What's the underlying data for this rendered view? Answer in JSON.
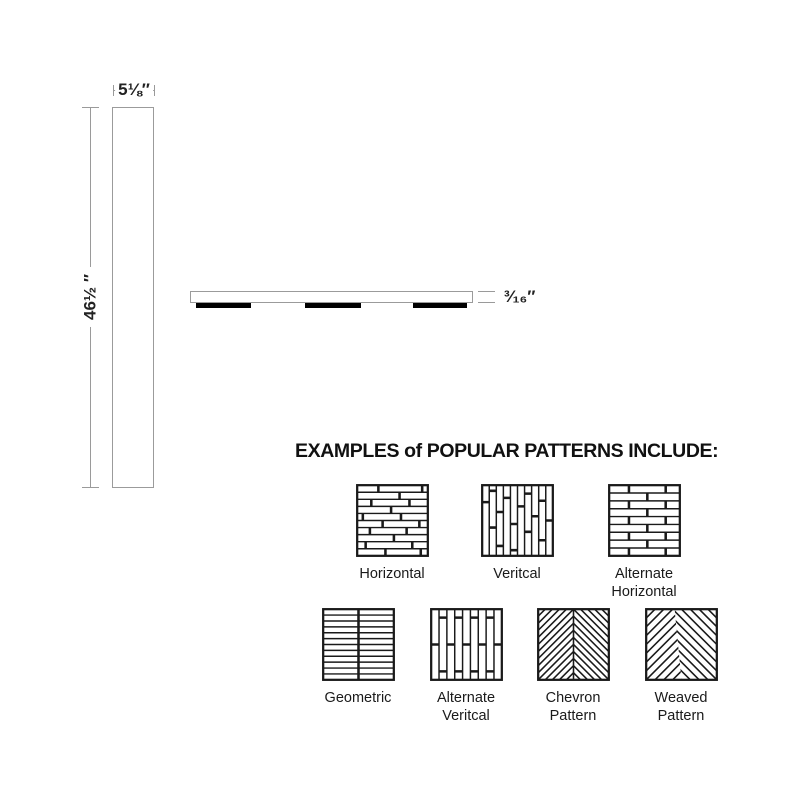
{
  "dimensions": {
    "width_label": "5⅛″",
    "height_label": "46½ ″",
    "thickness_label": "³⁄₁₆″"
  },
  "patterns_section": {
    "title": "EXAMPLES of POPULAR PATTERNS INCLUDE:",
    "rows": [
      [
        {
          "label": "Horizontal",
          "type": "horizontal"
        },
        {
          "label": "Veritcal",
          "type": "vertical"
        },
        {
          "label": "Alternate Horizontal",
          "type": "alt-horizontal"
        }
      ],
      [
        {
          "label": "Geometric",
          "type": "geometric"
        },
        {
          "label": "Alternate Veritcal",
          "type": "alt-vertical"
        },
        {
          "label": "Chevron Pattern",
          "type": "chevron"
        },
        {
          "label": "Weaved Pattern",
          "type": "weaved"
        }
      ]
    ]
  },
  "colors": {
    "ink": "#1a1a1a",
    "dim_line": "#9a9a9a",
    "pad": "#000000"
  }
}
